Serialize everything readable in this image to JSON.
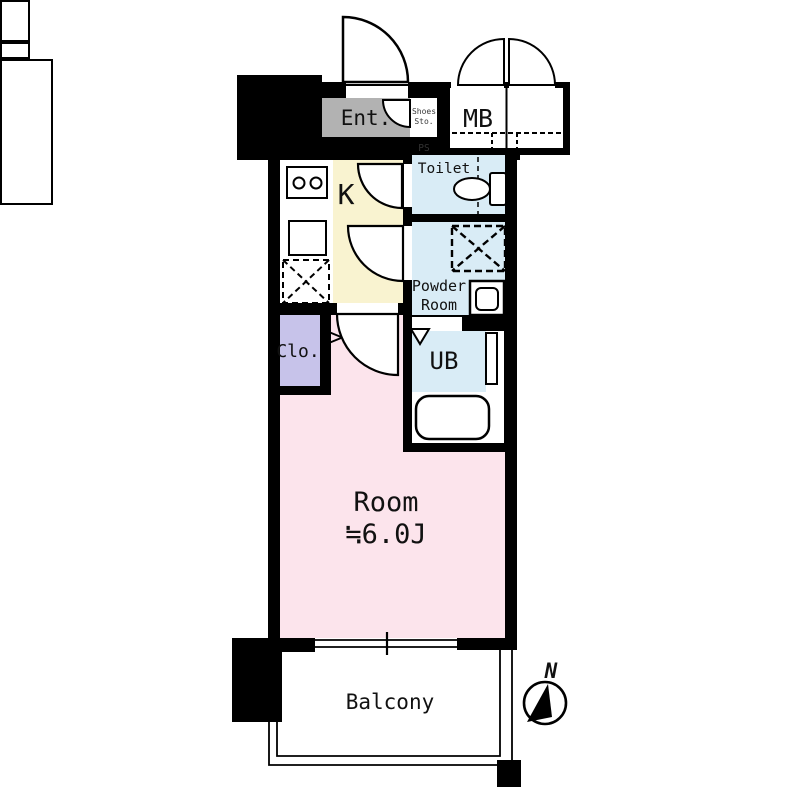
{
  "rooms": {
    "entrance": {
      "label": "Ent."
    },
    "shoes_storage": {
      "line1": "Shoes",
      "line2": "Sto."
    },
    "pipe_space": {
      "label": "PS"
    },
    "meter_box": {
      "label": "MB"
    },
    "kitchen": {
      "label": "K"
    },
    "toilet": {
      "label": "Toilet"
    },
    "powder_room": {
      "line1": "Powder",
      "line2": "Room"
    },
    "closet": {
      "label": "Clo."
    },
    "unit_bath": {
      "label": "UB"
    },
    "main_room": {
      "line1": "Room",
      "line2": "≒6.0J"
    },
    "balcony": {
      "label": "Balcony"
    }
  },
  "compass": {
    "north": "N"
  },
  "colors": {
    "wall": "#000000",
    "entrance_floor": "#b2b2b2",
    "kitchen_floor": "#f9f3d0",
    "wet_area_floor": "#d9ecf6",
    "closet_floor": "#c7c3ea",
    "room_floor": "#fce4ec",
    "fixture_fill": "#ffffff"
  },
  "icons": {
    "entrance_door": "door-swing-arc",
    "meter_box_doors": "double-door-swing-arcs",
    "shoes_storage_door": "door-swing-arc",
    "toilet_door": "door-swing-arc",
    "powder_room_door": "door-swing-arc",
    "room_door": "door-swing-arc",
    "stove": "two-burner-stove",
    "kitchen_sink": "sink-square",
    "refrigerator_space": "dashed-box-with-x",
    "toilet_fixture": "toilet-bowl-and-tank",
    "washing_machine_space": "dashed-box-with-x",
    "powder_sink": "vanity-sink",
    "unit_bath_door_panel": "door-panel",
    "unit_bath_entry_marker": "triangle-marker",
    "bathtub": "bathtub",
    "window": "sliding-window",
    "balcony_railing": "railing-lines",
    "compass": "north-compass"
  }
}
